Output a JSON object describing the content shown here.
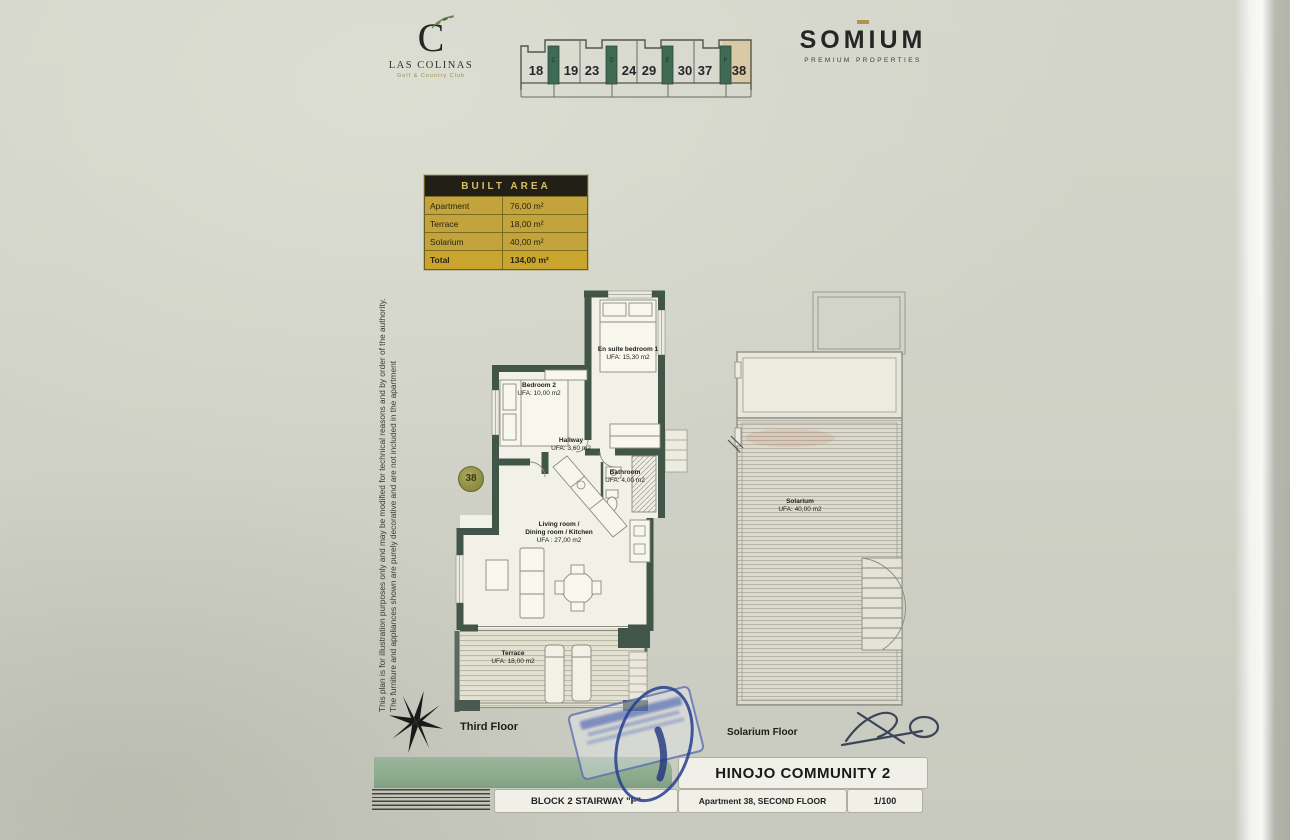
{
  "branding": {
    "las_colinas": {
      "initial": "C",
      "name": "LAS COLINAS",
      "subtitle": "Golf & Country Club"
    },
    "somium": {
      "name": "SOMIUM",
      "subtitle": "PREMIUM PROPERTIES"
    }
  },
  "key_plan": {
    "units": [
      "18",
      "19",
      "23",
      "24",
      "29",
      "30",
      "37",
      "38"
    ],
    "stairways": [
      "C",
      "D",
      "E",
      "F"
    ],
    "highlighted_unit": "38"
  },
  "built_area": {
    "title": "BUILT AREA",
    "rows": [
      {
        "label": "Apartment",
        "value": "76,00 m²"
      },
      {
        "label": "Terrace",
        "value": "18,00 m²"
      },
      {
        "label": "Solarium",
        "value": "40,00 m²"
      },
      {
        "label": "Total",
        "value": "134,00 m²"
      }
    ]
  },
  "disclaimer": {
    "line1": "This plan is for illustration purposes only and may be modified for technical reasons and by order of the authority.",
    "line2": "The furniture and appliances shown are purely decorative and are not included in the apartment"
  },
  "apartment_plan": {
    "unit_badge": "38",
    "rooms": {
      "bedroom1": {
        "name": "En suite bedroom 1",
        "area": "UFA: 15,30 m2"
      },
      "bedroom2": {
        "name": "Bedroom 2",
        "area": "UFA: 10,00 m2"
      },
      "hallway": {
        "name": "Hallway",
        "area": "UFA: 3,60 m2"
      },
      "bathroom": {
        "name": "Bathroom",
        "area": "UFA: 4,00 m2"
      },
      "living": {
        "name1": "Living room /",
        "name2": "Dining room / Kitchen",
        "area": "UFA : 27,00 m2"
      },
      "terrace": {
        "name": "Terrace",
        "area": "UFA: 18,00 m2"
      }
    },
    "floor_label": "Third Floor"
  },
  "solarium_plan": {
    "room": {
      "name": "Solarium",
      "area": "UFA: 40,00 m2"
    },
    "floor_label": "Solarium Floor"
  },
  "title_block": {
    "community": "HINOJO COMMUNITY 2",
    "block": "BLOCK 2 STAIRWAY \"F\"",
    "apartment": "Apartment 38, SECOND FLOOR",
    "scale": "1/100"
  },
  "colors": {
    "wall": "#415649",
    "accent_green": "#8fae92",
    "table_gold": "#c2a33c",
    "stamp_blue": "#3b55a5"
  }
}
